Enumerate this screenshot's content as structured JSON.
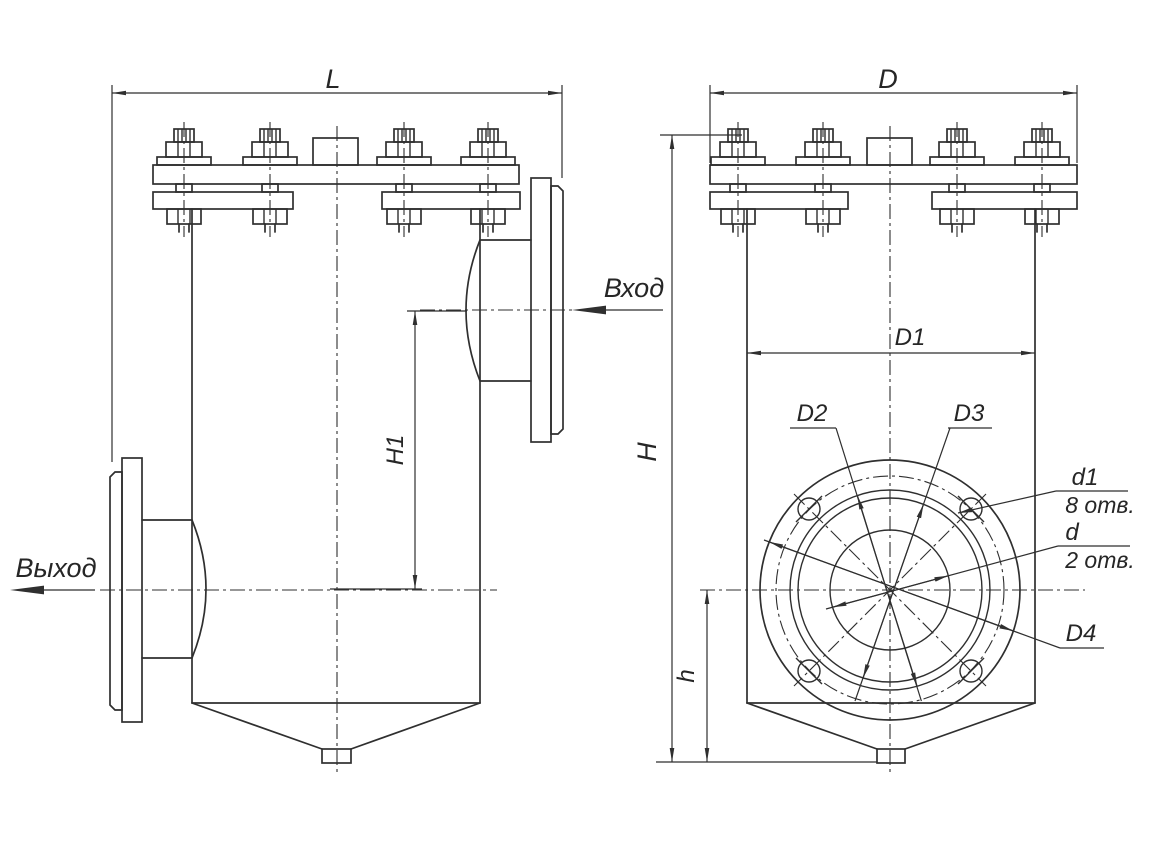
{
  "drawing": {
    "title_hint": "strainer-vessel-two-view-drawing",
    "colors": {
      "line": "#2f2f2f",
      "background": "#ffffff"
    },
    "flow_labels": {
      "inlet": "Вход",
      "outlet": "Выход"
    },
    "dimensions": {
      "overall_length": "L",
      "overall_width": "D",
      "overall_height": "H",
      "inlet_drop": "H1",
      "bottom_height": "h",
      "shell_diameter": "D1",
      "ring_outer": "D2",
      "ring_inner": "D3",
      "flange_outer": "D4",
      "bolt_hole": "d1",
      "bolt_hole_count": "8 отв.",
      "port_hole": "d",
      "port_hole_count": "2 отв."
    }
  }
}
